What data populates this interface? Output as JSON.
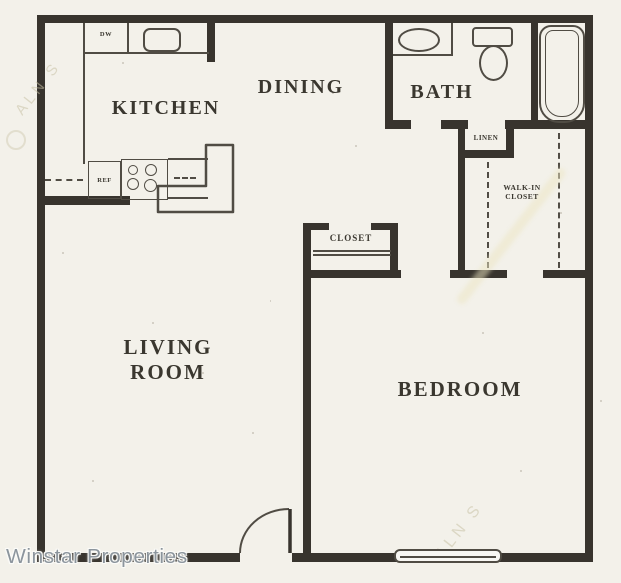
{
  "colors": {
    "paper": "#f3f1ea",
    "wall": "#38342e",
    "line": "#504c44",
    "label": "#3a372f",
    "watermark": "#8c959d",
    "ghost": "#c9c2a6"
  },
  "rooms": {
    "kitchen": {
      "label": "KITCHEN"
    },
    "dining": {
      "label": "DINING"
    },
    "bath": {
      "label": "BATH"
    },
    "living_room": {
      "line1": "LIVING",
      "line2": "ROOM"
    },
    "bedroom": {
      "label": "BEDROOM"
    },
    "closet": {
      "label": "CLOSET"
    },
    "linen_closet": {
      "label": "LINEN"
    },
    "walk_in_closet": {
      "line1": "WALK-IN",
      "line2": "CLOSET"
    }
  },
  "appliances": {
    "dishwasher": "DW",
    "refrigerator": "REF"
  },
  "branding": {
    "watermark": "Winstar Properties"
  },
  "scan_artifacts": {
    "diagonal_watermark": "ALN S"
  }
}
